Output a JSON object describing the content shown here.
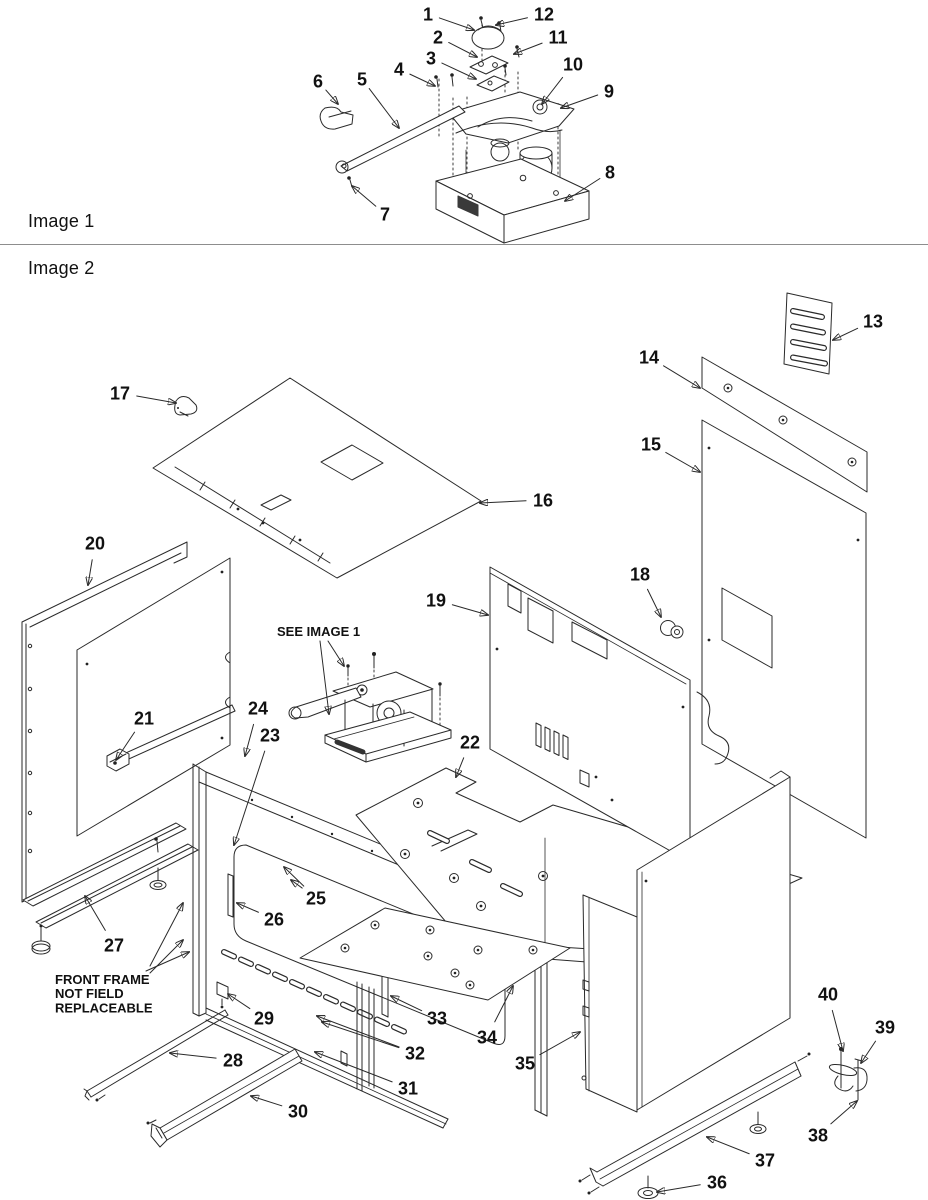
{
  "colors": {
    "ink": "#1f1f1f",
    "background": "#ffffff",
    "divider": "#8d8d8d"
  },
  "sections": {
    "image1_label": "Image 1",
    "image2_label": "Image 2"
  },
  "divider": {
    "y": 245
  },
  "annotations": [
    {
      "id": "see-image-1",
      "lines": [
        "SEE IMAGE 1"
      ],
      "x": 277,
      "y": 636,
      "size": 13,
      "lh": 14,
      "leaders": [
        {
          "x1": 320,
          "y1": 641,
          "x2": 329,
          "y2": 714
        },
        {
          "x1": 328,
          "y1": 641,
          "x2": 344,
          "y2": 666
        }
      ]
    },
    {
      "id": "front-frame-note",
      "lines": [
        "FRONT FRAME",
        "NOT FIELD",
        "REPLACEABLE"
      ],
      "x": 55,
      "y": 984,
      "size": 13,
      "lh": 14.2,
      "leaders": [
        {
          "x1": 146,
          "y1": 971,
          "x2": 189,
          "y2": 952
        },
        {
          "x1": 150,
          "y1": 966,
          "x2": 183,
          "y2": 903
        },
        {
          "x1": 150,
          "y1": 973,
          "x2": 183,
          "y2": 940
        }
      ]
    }
  ],
  "callouts": [
    {
      "n": "1",
      "lx": 428,
      "ly": 14,
      "ax": 474,
      "ay": 30
    },
    {
      "n": "2",
      "lx": 438,
      "ly": 37,
      "ax": 477,
      "ay": 57
    },
    {
      "n": "3",
      "lx": 431,
      "ly": 58,
      "ax": 476,
      "ay": 79
    },
    {
      "n": "4",
      "lx": 399,
      "ly": 69,
      "ax": 435,
      "ay": 86
    },
    {
      "n": "5",
      "lx": 362,
      "ly": 79,
      "ax": 399,
      "ay": 128
    },
    {
      "n": "6",
      "lx": 318,
      "ly": 81,
      "ax": 338,
      "ay": 104
    },
    {
      "n": "7",
      "lx": 385,
      "ly": 214,
      "ax": 352,
      "ay": 186
    },
    {
      "n": "8",
      "lx": 610,
      "ly": 172,
      "ax": 565,
      "ay": 201
    },
    {
      "n": "9",
      "lx": 609,
      "ly": 91,
      "ax": 561,
      "ay": 108
    },
    {
      "n": "10",
      "lx": 573,
      "ly": 64,
      "ax": 542,
      "ay": 104
    },
    {
      "n": "11",
      "lx": 558,
      "ly": 37,
      "ax": 514,
      "ay": 54
    },
    {
      "n": "12",
      "lx": 544,
      "ly": 14,
      "ax": 496,
      "ay": 25
    },
    {
      "n": "13",
      "lx": 873,
      "ly": 321,
      "ax": 833,
      "ay": 340
    },
    {
      "n": "14",
      "lx": 649,
      "ly": 357,
      "ax": 700,
      "ay": 388
    },
    {
      "n": "15",
      "lx": 651,
      "ly": 444,
      "ax": 700,
      "ay": 472
    },
    {
      "n": "16",
      "lx": 543,
      "ly": 500,
      "ax": 480,
      "ay": 503
    },
    {
      "n": "17",
      "lx": 120,
      "ly": 393,
      "ax": 176,
      "ay": 403
    },
    {
      "n": "18",
      "lx": 640,
      "ly": 574,
      "ax": 661,
      "ay": 617
    },
    {
      "n": "19",
      "lx": 436,
      "ly": 600,
      "ax": 488,
      "ay": 615
    },
    {
      "n": "20",
      "lx": 95,
      "ly": 543,
      "ax": 88,
      "ay": 585
    },
    {
      "n": "21",
      "lx": 144,
      "ly": 718,
      "ax": 116,
      "ay": 760
    },
    {
      "n": "22",
      "lx": 470,
      "ly": 742,
      "ax": 456,
      "ay": 777
    },
    {
      "n": "23",
      "lx": 270,
      "ly": 735,
      "ax": 234,
      "ay": 845
    },
    {
      "n": "24",
      "lx": 258,
      "ly": 708,
      "ax": 245,
      "ay": 756
    },
    {
      "n": "25",
      "lx": 316,
      "ly": 898,
      "ax": 284,
      "ay": 867,
      "ax2": 291,
      "ay2": 880
    },
    {
      "n": "26",
      "lx": 274,
      "ly": 919,
      "ax": 237,
      "ay": 903
    },
    {
      "n": "27",
      "lx": 114,
      "ly": 945,
      "ax": 85,
      "ay": 896
    },
    {
      "n": "28",
      "lx": 233,
      "ly": 1060,
      "ax": 170,
      "ay": 1053
    },
    {
      "n": "29",
      "lx": 264,
      "ly": 1018,
      "ax": 228,
      "ay": 994
    },
    {
      "n": "30",
      "lx": 298,
      "ly": 1111,
      "ax": 251,
      "ay": 1096
    },
    {
      "n": "31",
      "lx": 408,
      "ly": 1088,
      "ax": 315,
      "ay": 1052
    },
    {
      "n": "32",
      "lx": 415,
      "ly": 1053,
      "ax": 317,
      "ay": 1016,
      "ax2": 322,
      "ay2": 1022
    },
    {
      "n": "33",
      "lx": 437,
      "ly": 1018,
      "ax": 391,
      "ay": 996
    },
    {
      "n": "34",
      "lx": 487,
      "ly": 1037,
      "ax": 513,
      "ay": 986
    },
    {
      "n": "35",
      "lx": 525,
      "ly": 1063,
      "ax": 580,
      "ay": 1032
    },
    {
      "n": "36",
      "lx": 717,
      "ly": 1182,
      "ax": 657,
      "ay": 1192
    },
    {
      "n": "37",
      "lx": 765,
      "ly": 1160,
      "ax": 707,
      "ay": 1137
    },
    {
      "n": "38",
      "lx": 818,
      "ly": 1135,
      "ax": 857,
      "ay": 1101
    },
    {
      "n": "39",
      "lx": 885,
      "ly": 1027,
      "ax": 861,
      "ay": 1063
    },
    {
      "n": "40",
      "lx": 828,
      "ly": 994,
      "ax": 843,
      "ay": 1051
    }
  ]
}
